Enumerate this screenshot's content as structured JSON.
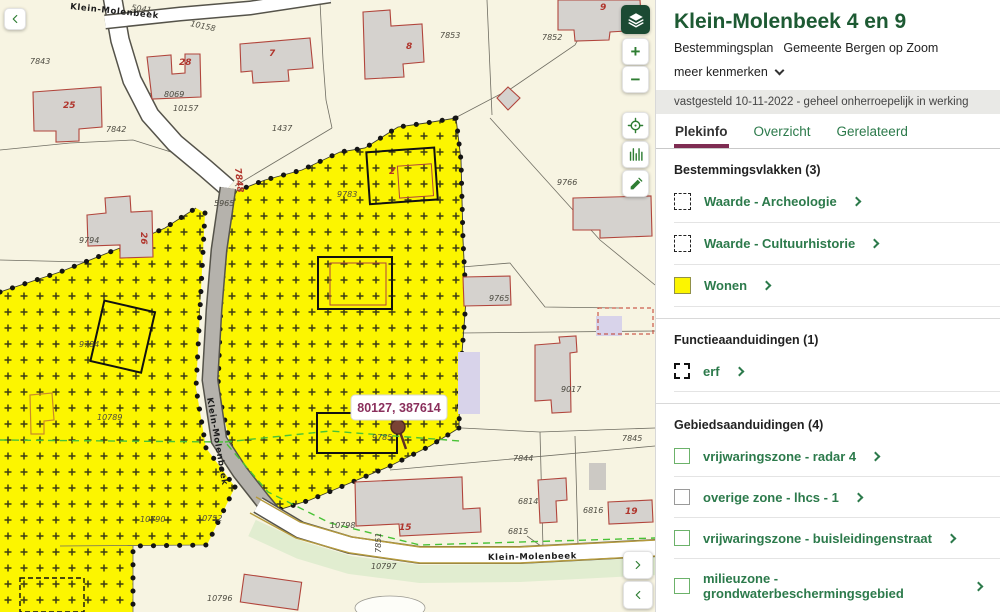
{
  "colors": {
    "title_green": "#1d5a33",
    "link_green": "#2c7a4b",
    "tab_underline": "#7e2c52",
    "coord_purple": "#8a2f5c",
    "map_yellow": "#fcf500",
    "map_bg": "#f7f4e2",
    "building_stroke": "#b1453c",
    "control_green": "#2e7d32",
    "layers_bg": "#1b4a33",
    "green_line": "#49c236",
    "road_olive": "#b59a3c"
  },
  "map": {
    "coordinate_label": "80127, 387614",
    "street_labels": [
      {
        "t": "Klein-Molenbeek",
        "x": 70,
        "y": 9,
        "r": 6
      },
      {
        "t": "Klein-Molenbeek",
        "x": 488,
        "y": 560,
        "r": -1
      },
      {
        "t": "Klein-Molenbeek",
        "x": 207,
        "y": 398,
        "r": 80
      }
    ],
    "parcel_labels": [
      {
        "t": "7843",
        "x": 30,
        "y": 64
      },
      {
        "t": "7842",
        "x": 106,
        "y": 132
      },
      {
        "t": "8069",
        "x": 164,
        "y": 97
      },
      {
        "t": "10157",
        "x": 173,
        "y": 111
      },
      {
        "t": "10158",
        "x": 190,
        "y": 26,
        "r": 12
      },
      {
        "t": "5041",
        "x": 131,
        "y": 10,
        "r": 8
      },
      {
        "t": "1437",
        "x": 272,
        "y": 131
      },
      {
        "t": "5965",
        "x": 214,
        "y": 206
      },
      {
        "t": "9783",
        "x": 337,
        "y": 197
      },
      {
        "t": "9794",
        "x": 79,
        "y": 243
      },
      {
        "t": "9784",
        "x": 79,
        "y": 347
      },
      {
        "t": "10789",
        "x": 97,
        "y": 420
      },
      {
        "t": "7853",
        "x": 440,
        "y": 38
      },
      {
        "t": "7852",
        "x": 542,
        "y": 40
      },
      {
        "t": "9766",
        "x": 557,
        "y": 185
      },
      {
        "t": "9765",
        "x": 489,
        "y": 301
      },
      {
        "t": "9017",
        "x": 561,
        "y": 392
      },
      {
        "t": "7845",
        "x": 622,
        "y": 441
      },
      {
        "t": "7844",
        "x": 513,
        "y": 461
      },
      {
        "t": "6814",
        "x": 518,
        "y": 504
      },
      {
        "t": "6816",
        "x": 583,
        "y": 513
      },
      {
        "t": "6815",
        "x": 508,
        "y": 534
      },
      {
        "t": "9785",
        "x": 372,
        "y": 440
      },
      {
        "t": "10790",
        "x": 140,
        "y": 522
      },
      {
        "t": "10752",
        "x": 197,
        "y": 521
      },
      {
        "t": "10798",
        "x": 330,
        "y": 528
      },
      {
        "t": "10797",
        "x": 371,
        "y": 569
      },
      {
        "t": "10796",
        "x": 207,
        "y": 601
      },
      {
        "t": "7851",
        "x": 381,
        "y": 553,
        "r": -90
      }
    ],
    "building_numbers": [
      {
        "t": "25",
        "x": 63,
        "y": 108
      },
      {
        "t": "28",
        "x": 179,
        "y": 65
      },
      {
        "t": "26",
        "x": 141,
        "y": 232,
        "r": 90
      },
      {
        "t": "7",
        "x": 269,
        "y": 56
      },
      {
        "t": "8",
        "x": 406,
        "y": 49
      },
      {
        "t": "9",
        "x": 600,
        "y": 10
      },
      {
        "t": "2",
        "x": 389,
        "y": 174
      },
      {
        "t": "15",
        "x": 399,
        "y": 530
      },
      {
        "t": "19",
        "x": 625,
        "y": 514
      },
      {
        "t": "7848",
        "x": 235,
        "y": 168,
        "r": 84
      }
    ],
    "controls": {
      "back": "chevron-left-icon",
      "layers": "layers-icon",
      "zoom_in": "+",
      "zoom_out": "−",
      "locate": "target-icon",
      "profile": "bars-icon",
      "draw": "pencil-icon",
      "panel_next": "chevron-right-icon",
      "panel_prev": "chevron-left-icon"
    }
  },
  "panel": {
    "title": "Klein-Molenbeek 4 en 9",
    "subtitle_type": "Bestemmingsplan",
    "subtitle_org": "Gemeente Bergen op Zoom",
    "more_link": "meer kenmerken",
    "status": "vastgesteld 10-11-2022 - geheel onherroepelijk in werking",
    "tabs": [
      {
        "label": "Plekinfo",
        "active": true
      },
      {
        "label": "Overzicht",
        "active": false
      },
      {
        "label": "Gerelateerd",
        "active": false
      }
    ],
    "sections": [
      {
        "title": "Bestemmingsvlakken (3)",
        "items": [
          {
            "label": "Waarde - Archeologie",
            "swatch": "dashed"
          },
          {
            "label": "Waarde - Cultuurhistorie",
            "swatch": "dashed"
          },
          {
            "label": "Wonen",
            "swatch": "yellow"
          }
        ]
      },
      {
        "title": "Functieaanduidingen (1)",
        "items": [
          {
            "label": "erf",
            "swatch": "dashed-bold"
          }
        ]
      },
      {
        "title": "Gebiedsaanduidingen (4)",
        "items": [
          {
            "label": "vrijwaringszone - radar 4",
            "swatch": "green-outline"
          },
          {
            "label": "overige zone - lhcs - 1",
            "swatch": "gray-outline"
          },
          {
            "label": "vrijwaringszone - buisleidingenstraat",
            "swatch": "green-outline"
          },
          {
            "label": "milieuzone - grondwaterbeschermingsgebied",
            "swatch": "green-outline"
          }
        ]
      }
    ]
  }
}
